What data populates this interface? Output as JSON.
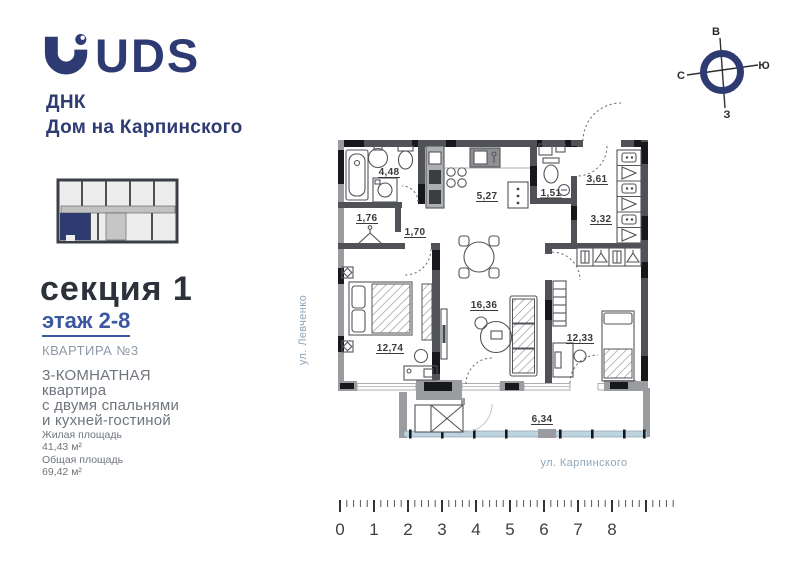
{
  "brand": {
    "logo": "UDS",
    "project_line1": "ДНК",
    "project_line2": "Дом на Карпинского"
  },
  "listing": {
    "section_title": "секция 1",
    "floor_range": "этаж 2-8",
    "apartment": "КВАРТИРА №3",
    "type_lines": [
      "3-КОМНАТНАЯ",
      "квартира",
      "с двумя спальнями",
      "и кухней-гостиной"
    ],
    "living_area_label": "Жилая площадь",
    "living_area_value": "41,43 м²",
    "total_area_label": "Общая площадь",
    "total_area_value": "69,42 м²"
  },
  "compass": {
    "top": "В",
    "right": "Ю",
    "left": "С",
    "bottom": "З"
  },
  "plan": {
    "streets": {
      "left": "ул. Левченко",
      "bottom": "ул. Карпинского"
    },
    "rooms": [
      {
        "name": "bathroom",
        "area": "4,48"
      },
      {
        "name": "kitchen",
        "area": "5,27"
      },
      {
        "name": "wc",
        "area": "1,51"
      },
      {
        "name": "hallway-entry",
        "area": "3,61"
      },
      {
        "name": "hallway",
        "area": "3,32"
      },
      {
        "name": "wardrobe",
        "area": "1,76"
      },
      {
        "name": "corridor",
        "area": "1,70"
      },
      {
        "name": "living-kitchen",
        "area": "16,36"
      },
      {
        "name": "bedroom-1",
        "area": "12,74"
      },
      {
        "name": "bedroom-2",
        "area": "12,33"
      },
      {
        "name": "balcony",
        "area": "6,34"
      }
    ]
  },
  "ruler": {
    "labels": [
      "0",
      "1",
      "2",
      "3",
      "4",
      "5",
      "6",
      "7",
      "8"
    ]
  },
  "colors": {
    "brand_navy": "#2e3b73",
    "floor_link_blue": "#3a57a0",
    "muted_blue_gray": "#8fa6ba",
    "text_gray": "#6e757d",
    "wall_dark": "#515257",
    "wall_black": "#17181b",
    "wall_gray": "#9b9ca0",
    "glazing_blue": "#bdd3e0",
    "highlight_unit": "#2e3b73"
  }
}
